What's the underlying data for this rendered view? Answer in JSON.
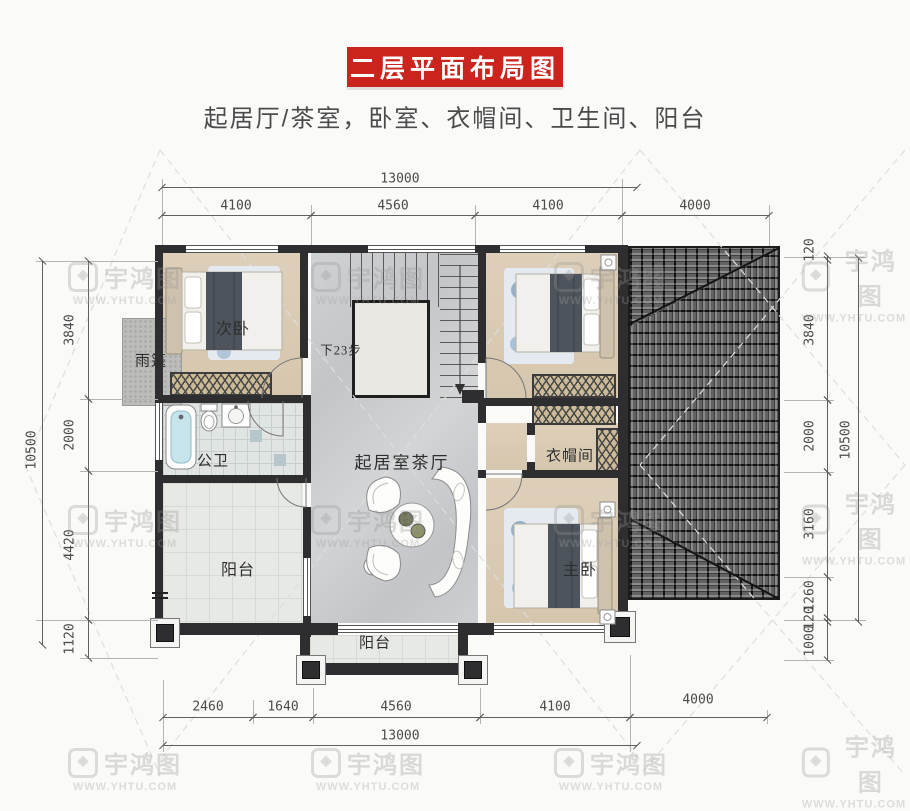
{
  "header": {
    "title": "二层平面布局图",
    "subtitle": "起居厅/茶室，卧室、衣帽间、卫生间、阳台"
  },
  "rooms": {
    "secondary_bedroom": "次卧",
    "canopy": "雨篷",
    "bathroom": "公卫",
    "living_tea_hall": "起居室茶厅",
    "cloakroom": "衣帽间",
    "master_bedroom": "主卧",
    "balcony_left": "阳台",
    "balcony_bottom": "阳台",
    "stair_note": "下23步"
  },
  "dimensions": {
    "top": {
      "overall": "13000",
      "segments": [
        "4100",
        "4560",
        "4100",
        "4000"
      ]
    },
    "bottom": {
      "overall": "13000",
      "segments": [
        "2460",
        "1640",
        "4560",
        "4100",
        "4000"
      ]
    },
    "left": {
      "overall": "10500",
      "segments": [
        "3840",
        "2000",
        "4420",
        "1120"
      ]
    },
    "right": {
      "overall": "10500",
      "segments": [
        "120",
        "3840",
        "2000",
        "3160",
        "1260",
        "120",
        "1000"
      ]
    }
  },
  "watermark": {
    "brand": "宇鸿图",
    "url": "WWW.YHTU.COM"
  },
  "colors": {
    "accent_red": "#cb241e",
    "wall": "#2e2e30",
    "roof_tile": "#6e6e6e",
    "wood_floor": "#dccdb6",
    "marble_floor": "#c9cbcd",
    "bathtub_blue": "#c6e4ec"
  }
}
